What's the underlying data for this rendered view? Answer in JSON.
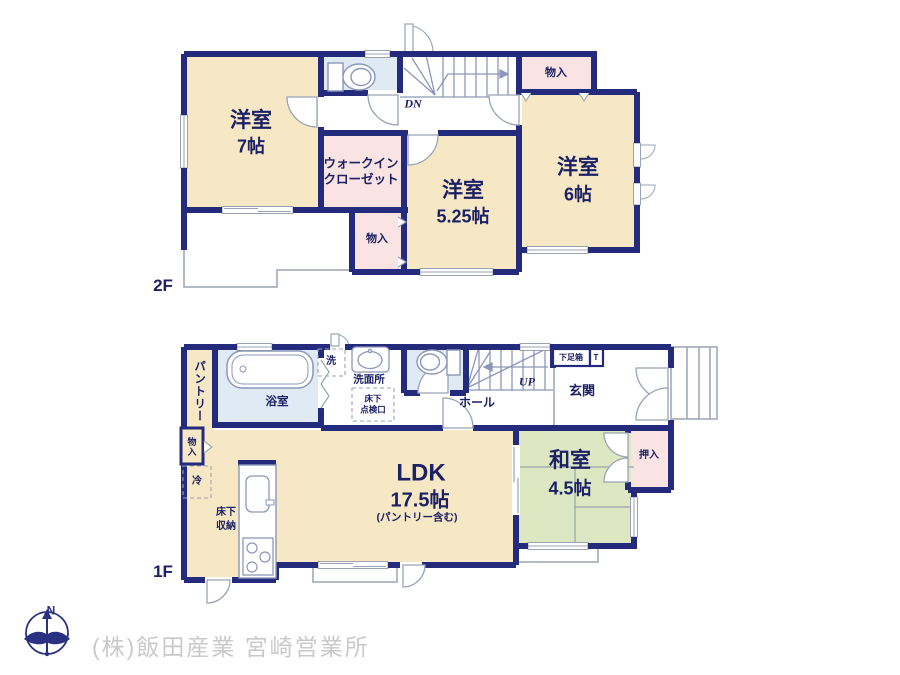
{
  "palette": {
    "wall_navy": "#242b7d",
    "label_navy": "#1c2166",
    "room_beige": "#f6e8c5",
    "closet_pink": "#f9e3e3",
    "wet_area_blue": "#dfeaf4",
    "tatami_green": "#dde8c2",
    "thin_line_gray": "#9aa3b3",
    "company_gray": "#c9c9cb"
  },
  "floor2": {
    "label": "2F",
    "room_west": {
      "name": "洋室",
      "size": "7帖"
    },
    "walkin_closet": {
      "line1": "ウォークイン",
      "line2": "クローゼット"
    },
    "room_center": {
      "name": "洋室",
      "size": "5.25帖"
    },
    "room_east": {
      "name": "洋室",
      "size": "6帖"
    },
    "closet_top": "物入",
    "closet_mid": "物入",
    "stairs_label": "DN"
  },
  "floor1": {
    "label": "1F",
    "ldk": {
      "name": "LDK",
      "size": "17.5帖",
      "note": "(パントリー含む)"
    },
    "washitsu": {
      "name": "和室",
      "size": "4.5帖"
    },
    "pantry": "パントリー",
    "bathroom": "浴室",
    "laundry": "洗",
    "washroom": "洗面所",
    "inspection_hatch": {
      "line1": "床下",
      "line2": "点検口"
    },
    "underfloor_storage": {
      "line1": "床下",
      "line2": "収納"
    },
    "fridge": "冷",
    "closet_left": "物入",
    "hall": "ホール",
    "stairs_label": "UP",
    "entrance": "玄関",
    "shoe_box": "下足箱",
    "shoe_box_t": "T",
    "oshiire": "押入"
  },
  "footer": {
    "company": "(株)飯田産業 宮崎営業所",
    "compass_north": "N"
  }
}
